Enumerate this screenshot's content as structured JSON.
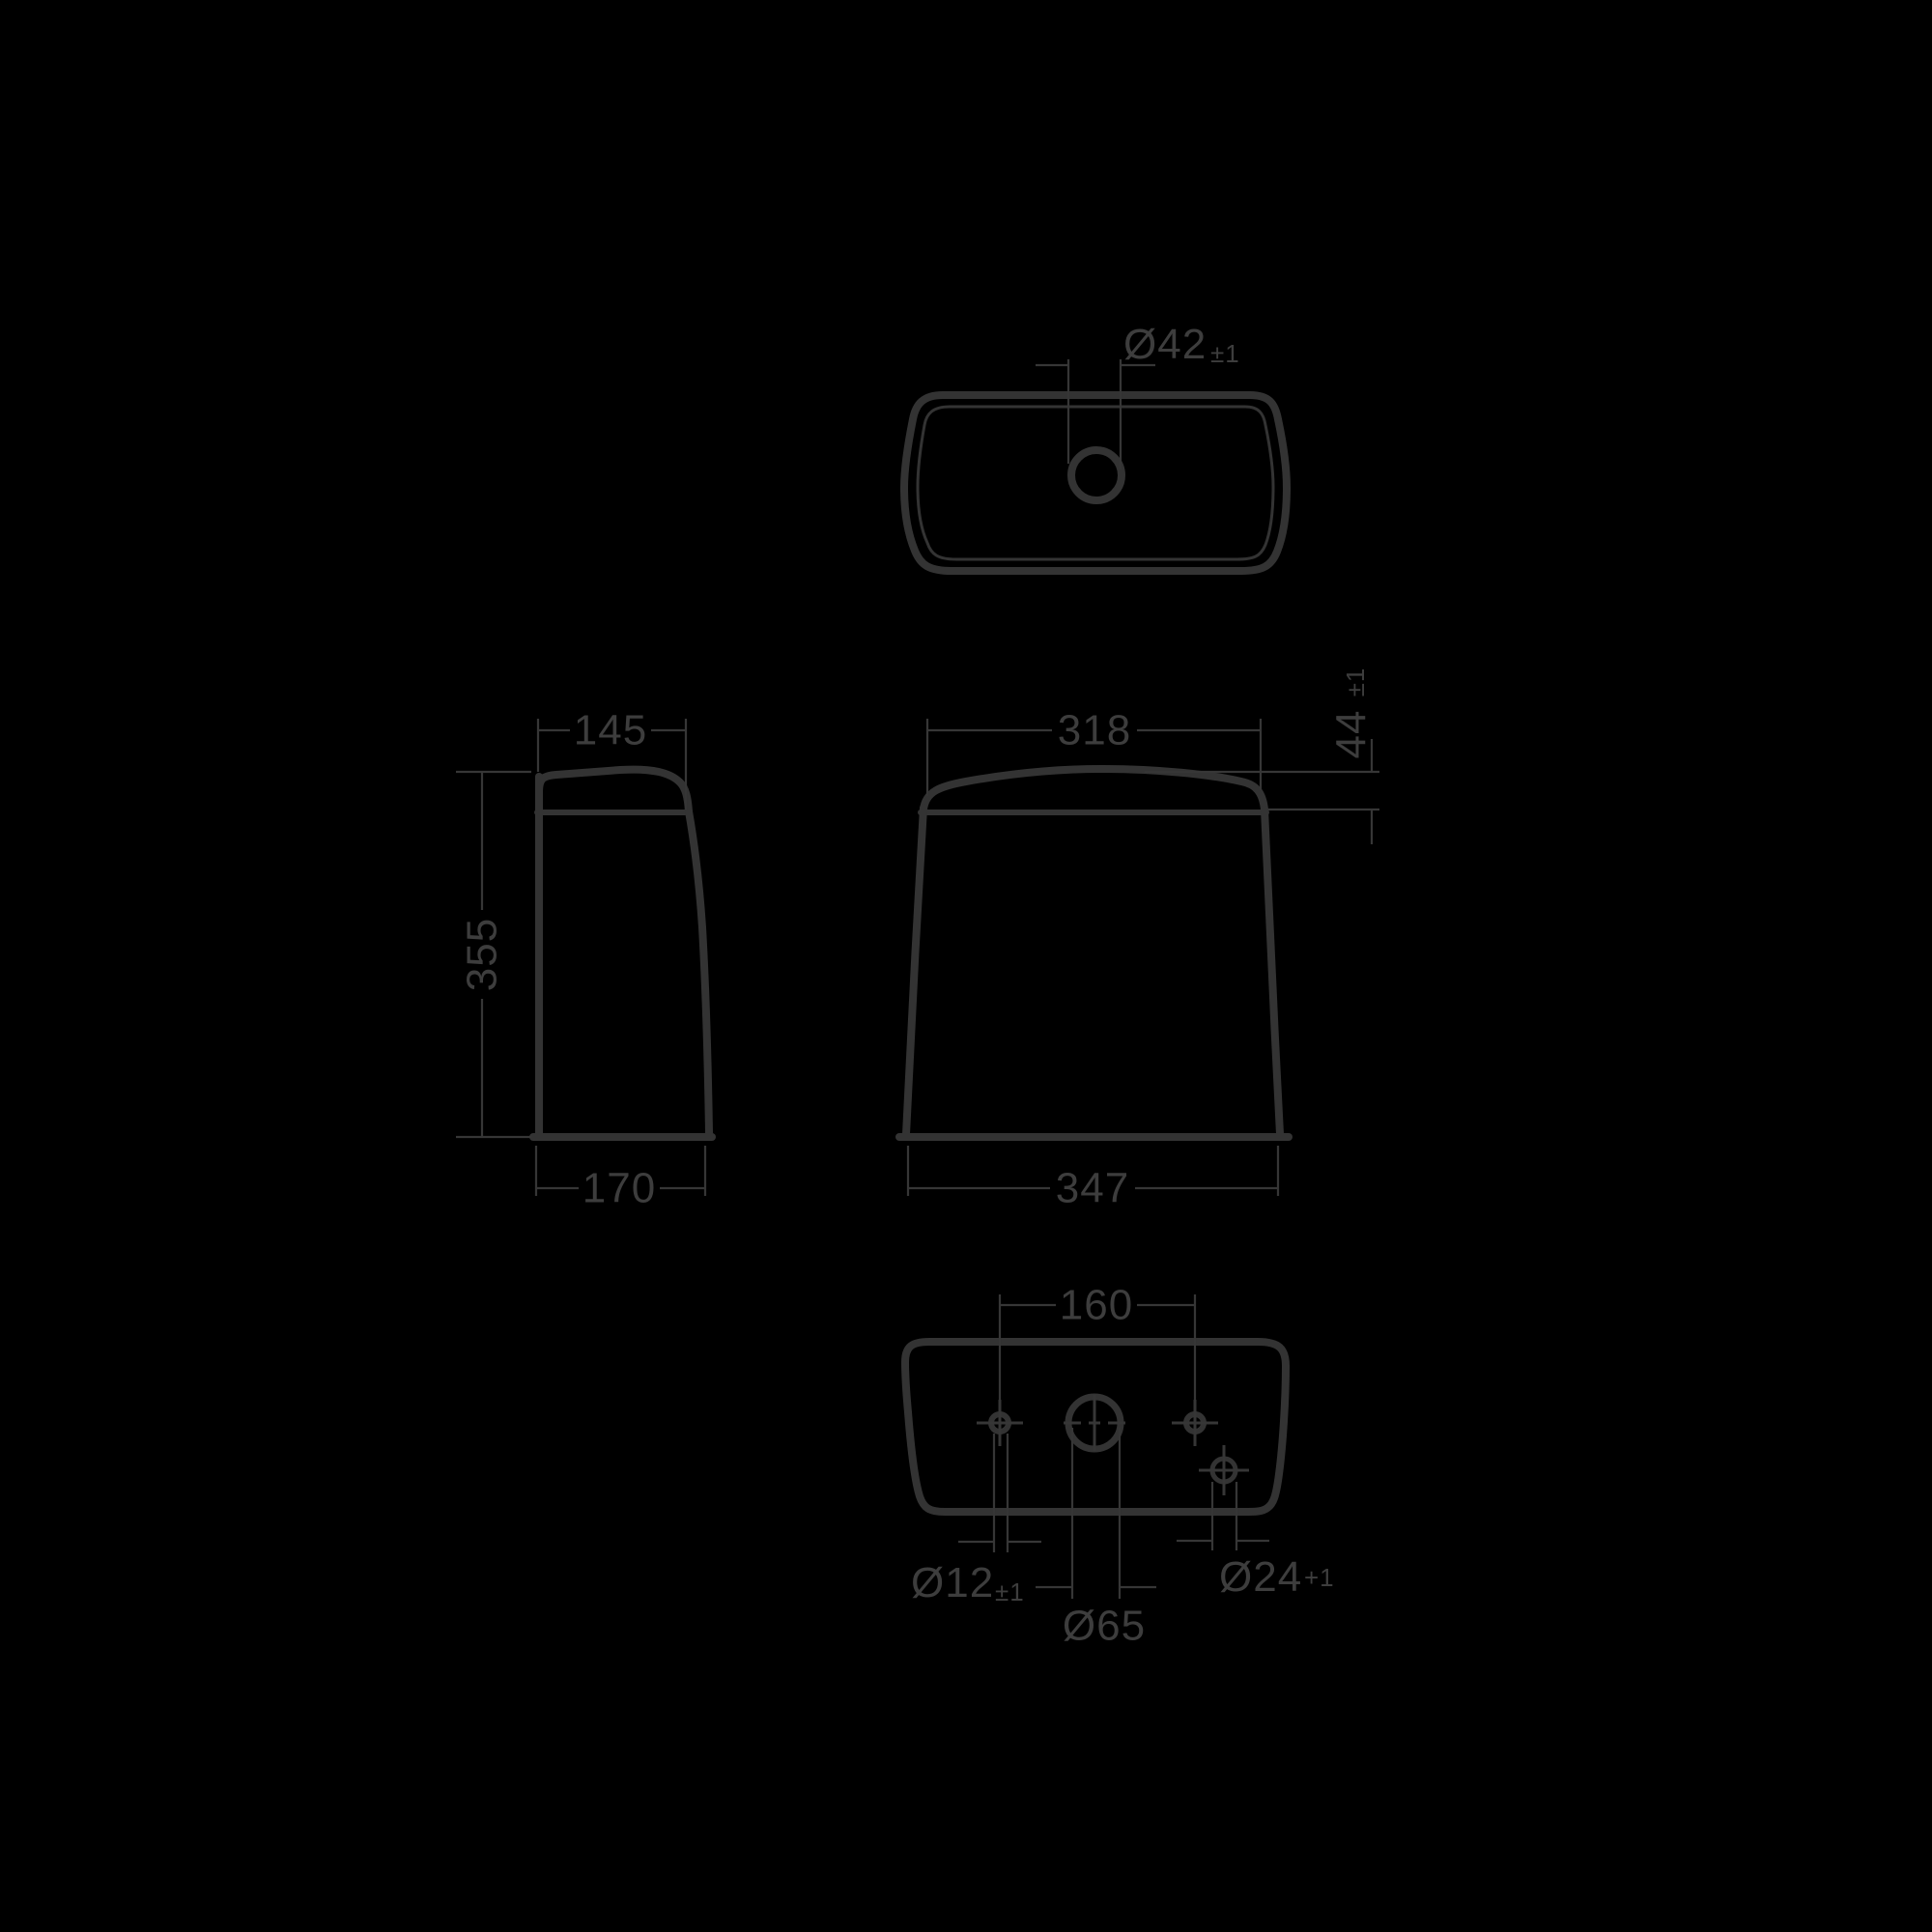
{
  "colors": {
    "background": "#000000",
    "line": "#333333",
    "text": "#3d3d3d"
  },
  "views": {
    "top": {
      "hole_diameter": "Ø42",
      "hole_diameter_tolerance": "±1"
    },
    "side": {
      "top_width": "145",
      "height": "355",
      "bottom_depth": "170"
    },
    "front": {
      "top_width": "318",
      "lid_height": "44",
      "lid_height_tolerance": "±1",
      "bottom_width": "347"
    },
    "bottom": {
      "fixing_hole_spacing": "160",
      "fixing_hole_diameter": "Ø12",
      "fixing_hole_tolerance": "±1",
      "flush_valve_diameter": "Ø65",
      "inlet_hole_diameter": "Ø24",
      "inlet_hole_tolerance": "+1"
    }
  }
}
